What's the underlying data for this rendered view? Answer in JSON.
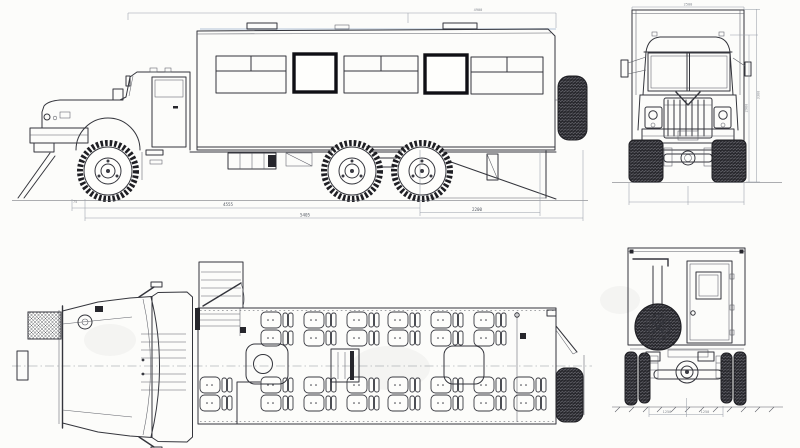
{
  "palette": {
    "paper": "#fcfcfa",
    "ink": "#34353c",
    "thin_ink": "#5c5e66",
    "window_frame": "#0f0f14",
    "tire": "#27272c",
    "dimension_line": "#989ea8"
  },
  "drawing": {
    "kind": "orthographic-technical-drawing",
    "views": [
      "side-elevation",
      "front-elevation",
      "plan-interior",
      "rear-elevation"
    ]
  },
  "dims": {
    "side_upper": "4900",
    "side_front_section": "4555",
    "side_rear_section": "2200",
    "side_total": "5405",
    "side_left_note": "75",
    "front_width": "2500",
    "front_height_cab": "2980",
    "front_height_total": "3300",
    "rear_track_left": "1250",
    "rear_track_right": "1250"
  },
  "plan_seats": {
    "top_row_x": [
      261,
      304,
      347,
      388,
      431,
      474
    ],
    "bottom_row_x": [
      200,
      261,
      304,
      347,
      388,
      431,
      474,
      514
    ],
    "row_top_y": 312,
    "row_bottom_y": 377,
    "seats_per_unit": 2,
    "total_seats": 28
  }
}
